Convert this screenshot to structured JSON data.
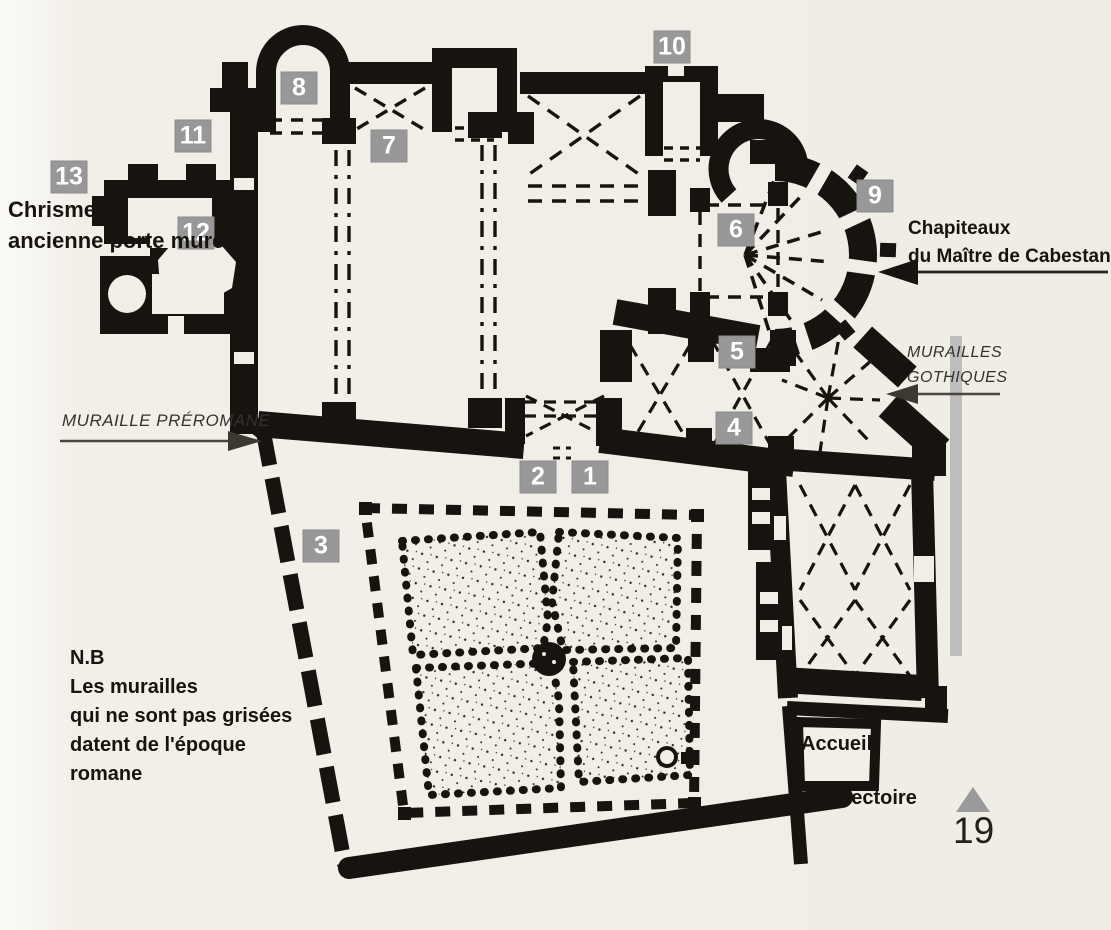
{
  "page": {
    "number": "19",
    "ink": "#17140f"
  },
  "annotations": {
    "chrisme": {
      "line1": "Chrisme,",
      "line2": "ancienne porte murée"
    },
    "muraille_preromane": "MURAILLE PRÉROMANE",
    "chapiteaux": {
      "line1": "Chapiteaux",
      "line2": "du Maître de Cabestany"
    },
    "murailles_gothiques": {
      "line1": "MURAILLES",
      "line2": "GOTHIQUES"
    },
    "nb": {
      "line1": "N.B",
      "line2": "Les murailles",
      "line3": "qui ne sont pas grisées",
      "line4": "datent de l'époque",
      "line5": "romane"
    },
    "accueil": "Accueil",
    "refectoire": "Réfectoire"
  },
  "markers": [
    {
      "n": "1",
      "x": 590,
      "y": 477
    },
    {
      "n": "2",
      "x": 538,
      "y": 477
    },
    {
      "n": "3",
      "x": 321,
      "y": 546
    },
    {
      "n": "4",
      "x": 734,
      "y": 428
    },
    {
      "n": "5",
      "x": 737,
      "y": 352
    },
    {
      "n": "6",
      "x": 736,
      "y": 230
    },
    {
      "n": "7",
      "x": 389,
      "y": 146
    },
    {
      "n": "8",
      "x": 299,
      "y": 88
    },
    {
      "n": "9",
      "x": 875,
      "y": 196
    },
    {
      "n": "10",
      "x": 672,
      "y": 47
    },
    {
      "n": "11",
      "x": 193,
      "y": 136
    },
    {
      "n": "12",
      "x": 196,
      "y": 233
    },
    {
      "n": "13",
      "x": 69,
      "y": 177
    }
  ],
  "colors": {
    "marker_bg": "#989898",
    "marker_text": "#ffffff",
    "gray_bar": "#bdbdbd",
    "triangle": "#9a9a9a"
  }
}
